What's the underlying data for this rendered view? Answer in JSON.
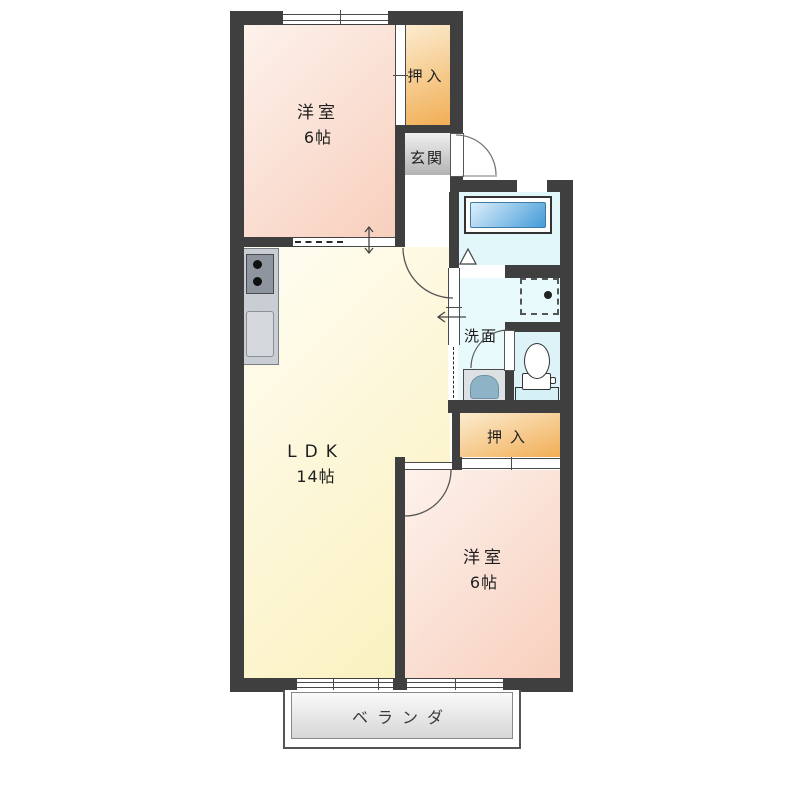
{
  "rooms": {
    "western_top": {
      "name": "洋室",
      "size": "6帖"
    },
    "ldk": {
      "name": "LDK",
      "size": "14帖"
    },
    "western_bottom": {
      "name": "洋室",
      "size": "6帖"
    },
    "closet_top": {
      "name": "押入"
    },
    "closet_bottom": {
      "name": "押入"
    },
    "entrance": {
      "name": "玄関"
    },
    "washroom": {
      "name": "洗面"
    },
    "veranda": {
      "name": "ベランダ"
    }
  },
  "fixtures": {
    "bathtub": "bathtub",
    "toilet": "toilet",
    "washbasin": "washbasin",
    "washer_space": "washing-machine-space",
    "stove": "kitchen-stove",
    "sink": "kitchen-sink"
  },
  "colors": {
    "wall": "#3f3f3f",
    "western_room": "#f8cfbd",
    "ldk": "#faf0bb",
    "closet": "#f1ae55",
    "entrance": "#b3b3b3",
    "wet_area": "#e2f7fa",
    "bathtub_blue": "#459bd8",
    "veranda": "#d6d6d6"
  }
}
